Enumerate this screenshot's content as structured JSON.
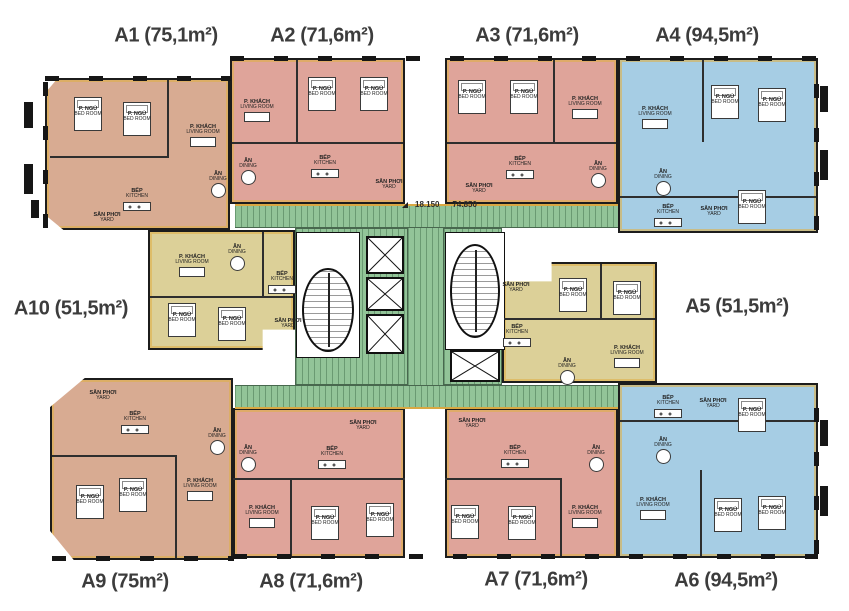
{
  "dimension": {
    "left": "18.150",
    "right": "74.850"
  },
  "room_labels": {
    "bedroom": {
      "vi": "P. NGỦ",
      "en": "BED ROOM"
    },
    "living": {
      "vi": "P. KHÁCH",
      "en": "LIVING ROOM"
    },
    "dining": {
      "vi": "ĂN",
      "en": "DINING"
    },
    "kitchen": {
      "vi": "BẾP",
      "en": "KITCHEN"
    },
    "yard": {
      "vi": "SÂN PHƠI",
      "en": "YARD"
    }
  },
  "colors": {
    "unit_brown": "#d8ab92",
    "unit_salmon": "#dfa49a",
    "unit_blue": "#a6cde4",
    "unit_yellow": "#dcd098",
    "core_green": "#92c498",
    "wall_black": "#1c1c1c",
    "accent_gold": "#e0b04a",
    "label_gray": "#3c3c3c"
  },
  "units": [
    {
      "id": "A1",
      "label": "A1 (75,1m²)",
      "area": "75,1m²",
      "color": "#d8ab92",
      "rooms": [
        {
          "type": "bedroom",
          "x": 88,
          "y": 112
        },
        {
          "type": "bedroom",
          "x": 137,
          "y": 117
        },
        {
          "type": "living",
          "x": 203,
          "y": 130
        },
        {
          "type": "dining",
          "x": 218,
          "y": 177
        },
        {
          "type": "kitchen",
          "x": 137,
          "y": 194
        },
        {
          "type": "yard",
          "x": 107,
          "y": 218
        }
      ]
    },
    {
      "id": "A2",
      "label": "A2 (71,6m²)",
      "area": "71,6m²",
      "color": "#dfa49a",
      "rooms": [
        {
          "type": "living",
          "x": 257,
          "y": 105
        },
        {
          "type": "bedroom",
          "x": 322,
          "y": 92
        },
        {
          "type": "bedroom",
          "x": 374,
          "y": 92
        },
        {
          "type": "dining",
          "x": 248,
          "y": 164
        },
        {
          "type": "kitchen",
          "x": 325,
          "y": 161
        },
        {
          "type": "yard",
          "x": 389,
          "y": 185
        }
      ]
    },
    {
      "id": "A3",
      "label": "A3 (71,6m²)",
      "area": "71,6m²",
      "color": "#dfa49a",
      "rooms": [
        {
          "type": "bedroom",
          "x": 472,
          "y": 95
        },
        {
          "type": "bedroom",
          "x": 524,
          "y": 95
        },
        {
          "type": "living",
          "x": 585,
          "y": 102
        },
        {
          "type": "kitchen",
          "x": 520,
          "y": 162
        },
        {
          "type": "dining",
          "x": 598,
          "y": 167
        },
        {
          "type": "yard",
          "x": 479,
          "y": 189
        }
      ]
    },
    {
      "id": "A4",
      "label": "A4 (94,5m²)",
      "area": "94,5m²",
      "color": "#a6cde4",
      "rooms": [
        {
          "type": "living",
          "x": 655,
          "y": 112
        },
        {
          "type": "bedroom",
          "x": 725,
          "y": 100
        },
        {
          "type": "bedroom",
          "x": 772,
          "y": 103
        },
        {
          "type": "dining",
          "x": 663,
          "y": 175
        },
        {
          "type": "kitchen",
          "x": 668,
          "y": 210
        },
        {
          "type": "yard",
          "x": 714,
          "y": 212
        },
        {
          "type": "bedroom",
          "x": 752,
          "y": 205
        }
      ]
    },
    {
      "id": "A5",
      "label": "A5 (51,5m²)",
      "area": "51,5m²",
      "color": "#dcd098",
      "rooms": [
        {
          "type": "yard",
          "x": 516,
          "y": 288
        },
        {
          "type": "kitchen",
          "x": 517,
          "y": 330
        },
        {
          "type": "bedroom",
          "x": 573,
          "y": 293
        },
        {
          "type": "bedroom",
          "x": 627,
          "y": 296
        },
        {
          "type": "living",
          "x": 627,
          "y": 351
        },
        {
          "type": "dining",
          "x": 567,
          "y": 364
        }
      ]
    },
    {
      "id": "A6",
      "label": "A6 (94,5m²)",
      "area": "94,5m²",
      "color": "#a6cde4",
      "rooms": [
        {
          "type": "kitchen",
          "x": 668,
          "y": 401
        },
        {
          "type": "yard",
          "x": 713,
          "y": 404
        },
        {
          "type": "bedroom",
          "x": 752,
          "y": 413
        },
        {
          "type": "dining",
          "x": 663,
          "y": 443
        },
        {
          "type": "living",
          "x": 653,
          "y": 503
        },
        {
          "type": "bedroom",
          "x": 728,
          "y": 513
        },
        {
          "type": "bedroom",
          "x": 772,
          "y": 511
        }
      ]
    },
    {
      "id": "A7",
      "label": "A7 (71,6m²)",
      "area": "71,6m²",
      "color": "#dfa49a",
      "rooms": [
        {
          "type": "yard",
          "x": 472,
          "y": 424
        },
        {
          "type": "kitchen",
          "x": 515,
          "y": 451
        },
        {
          "type": "dining",
          "x": 596,
          "y": 451
        },
        {
          "type": "living",
          "x": 585,
          "y": 511
        },
        {
          "type": "bedroom",
          "x": 465,
          "y": 520
        },
        {
          "type": "bedroom",
          "x": 522,
          "y": 521
        }
      ]
    },
    {
      "id": "A8",
      "label": "A8 (71,6m²)",
      "area": "71,6m²",
      "color": "#dfa49a",
      "rooms": [
        {
          "type": "dining",
          "x": 248,
          "y": 451
        },
        {
          "type": "kitchen",
          "x": 332,
          "y": 452
        },
        {
          "type": "yard",
          "x": 363,
          "y": 426
        },
        {
          "type": "living",
          "x": 262,
          "y": 511
        },
        {
          "type": "bedroom",
          "x": 325,
          "y": 521
        },
        {
          "type": "bedroom",
          "x": 380,
          "y": 518
        }
      ]
    },
    {
      "id": "A9",
      "label": "A9 (75m²)",
      "area": "75m²",
      "color": "#d8ab92",
      "rooms": [
        {
          "type": "yard",
          "x": 103,
          "y": 396
        },
        {
          "type": "kitchen",
          "x": 135,
          "y": 417
        },
        {
          "type": "dining",
          "x": 217,
          "y": 434
        },
        {
          "type": "living",
          "x": 200,
          "y": 484
        },
        {
          "type": "bedroom",
          "x": 90,
          "y": 500
        },
        {
          "type": "bedroom",
          "x": 133,
          "y": 493
        }
      ]
    },
    {
      "id": "A10",
      "label": "A10 (51,5m²)",
      "area": "51,5m²",
      "color": "#dcd098",
      "rooms": [
        {
          "type": "dining",
          "x": 237,
          "y": 250
        },
        {
          "type": "living",
          "x": 192,
          "y": 260
        },
        {
          "type": "kitchen",
          "x": 282,
          "y": 277
        },
        {
          "type": "bedroom",
          "x": 182,
          "y": 318
        },
        {
          "type": "bedroom",
          "x": 232,
          "y": 322
        },
        {
          "type": "yard",
          "x": 288,
          "y": 324
        }
      ]
    }
  ]
}
